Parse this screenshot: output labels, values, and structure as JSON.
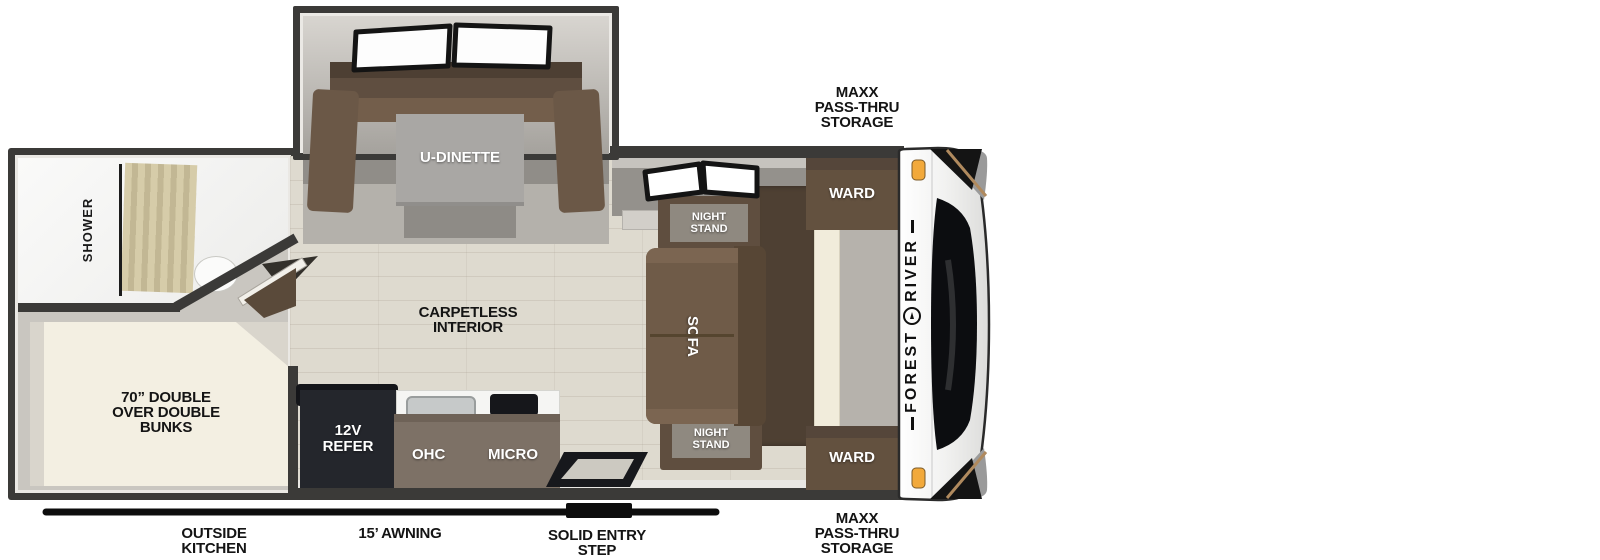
{
  "colors": {
    "wall": "#3b3a38",
    "floor_wood": "#dedacf",
    "furniture_brown": "#63513f",
    "furniture_brown_dark": "#4e4033",
    "cabinet_brown": "#7d7166",
    "refer_black": "#24262c",
    "bed_cream": "#f3efe2",
    "marker_orange": "#f2a93b",
    "label_black": "#141414"
  },
  "brand": {
    "word_top": "RIVER",
    "word_bottom": "FOREST"
  },
  "rooms": {
    "shower": "SHOWER",
    "bunks_line1": "70” DOUBLE",
    "bunks_line2": "OVER DOUBLE",
    "bunks_line3": "BUNKS",
    "carpetless_line1": "CARPETLESS",
    "carpetless_line2": "INTERIOR"
  },
  "furniture": {
    "u_dinette": "U-DINETTE",
    "night_stand_top_line1": "NIGHT",
    "night_stand_top_line2": "STAND",
    "night_stand_bottom_line1": "NIGHT",
    "night_stand_bottom_line2": "STAND",
    "ward_top": "WARD",
    "ward_bottom": "WARD",
    "sofa": "SOFA",
    "refer_line1": "12V",
    "refer_line2": "REFER",
    "ohc": "OHC",
    "micro": "MICRO"
  },
  "exterior": {
    "storage_top_line1": "MAXX",
    "storage_top_line2": "PASS-THRU",
    "storage_top_line3": "STORAGE",
    "storage_bottom_line1": "MAXX",
    "storage_bottom_line2": "PASS-THRU",
    "storage_bottom_line3": "STORAGE",
    "outside_kitchen_line1": "OUTSIDE",
    "outside_kitchen_line2": "KITCHEN",
    "awning": "15’ AWNING",
    "entry_step_line1": "SOLID ENTRY",
    "entry_step_line2": "STEP"
  }
}
